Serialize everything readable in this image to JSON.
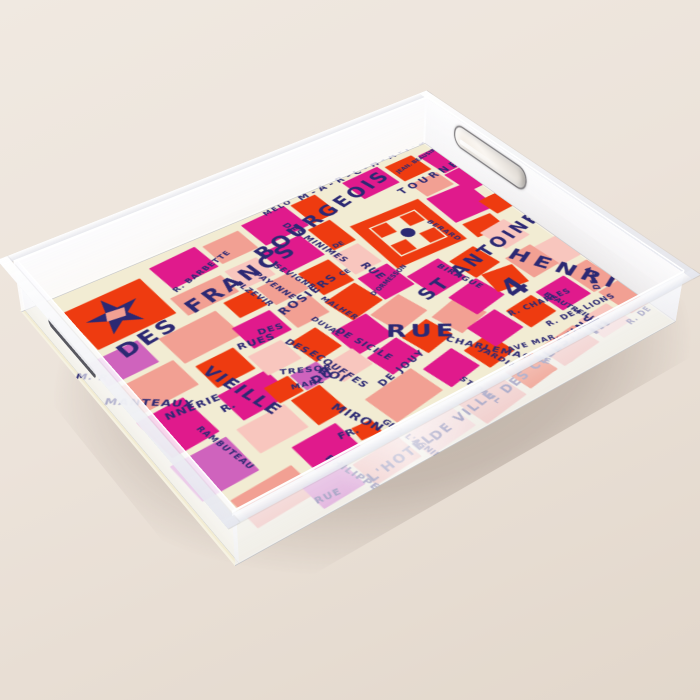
{
  "product": {
    "type": "acrylic serving tray product photo",
    "artwork": "Paris map print in pink, red and navy hand lettering",
    "setting": "beige studio surface"
  },
  "palette": {
    "background_top": "#f0e9e1",
    "background_bottom": "#e2d7cb",
    "cream": "#f2ecd3",
    "red": "#ee3b10",
    "magenta": "#e01a8c",
    "salmon": "#f2a093",
    "pink": "#f8c6be",
    "violet": "#cf63bd",
    "navy": "#2c2973"
  },
  "landmarks": {
    "star": "metro-star-marker",
    "place_square": "place-des-vosges-square",
    "place_dot": "place-des-vosges-dot"
  },
  "map": {
    "labels": [
      [
        "DES",
        48,
        104,
        27,
        3,
        -8
      ],
      [
        "FRANCS",
        136,
        86,
        27,
        4,
        -9
      ],
      [
        "BOURGEOIS",
        240,
        56,
        26,
        4,
        -12
      ],
      [
        "M-A-R-C-H-A-I-S",
        336,
        2,
        13,
        5,
        -3
      ],
      [
        "MELO",
        288,
        6,
        10,
        2,
        -6
      ],
      [
        "DES MINIMES",
        302,
        36,
        11,
        1,
        80
      ],
      [
        "JEAN. BEAUSIRE",
        456,
        28,
        8,
        0,
        -10
      ],
      [
        "TOURNELLES",
        434,
        58,
        14,
        5,
        -5
      ],
      [
        "R. BARBETTE",
        140,
        62,
        10,
        1,
        -16
      ],
      [
        "SEVIGNE",
        252,
        90,
        10,
        1,
        78
      ],
      [
        "PAYENNE",
        228,
        90,
        10,
        1,
        80
      ],
      [
        "ELZEVIR",
        204,
        90,
        10,
        1,
        80
      ],
      [
        "VIEILLE",
        114,
        182,
        19,
        2,
        75
      ],
      [
        "RUES",
        148,
        170,
        12,
        1,
        10
      ],
      [
        "DES",
        176,
        164,
        11,
        1,
        12
      ],
      [
        "ROSIERS",
        208,
        152,
        14,
        2,
        -12
      ],
      [
        "DES",
        196,
        194,
        11,
        1,
        72
      ],
      [
        "ECOUFFES",
        206,
        222,
        11,
        1,
        78
      ],
      [
        "TRESOR",
        162,
        226,
        10,
        1,
        28
      ],
      [
        "MARC",
        158,
        250,
        9,
        1,
        18
      ],
      [
        "DU",
        178,
        252,
        13,
        1,
        0
      ],
      [
        "ROI",
        198,
        246,
        13,
        1,
        65
      ],
      [
        "DE SICILE",
        246,
        210,
        11,
        1,
        75
      ],
      [
        "DUVAL",
        234,
        182,
        9,
        1,
        78
      ],
      [
        "MALHER",
        260,
        162,
        9,
        1,
        78
      ],
      [
        "MANTEAUX",
        10,
        162,
        12,
        1,
        38
      ],
      [
        "NNERIE",
        42,
        212,
        12,
        1,
        6
      ],
      [
        "RAMBUTEAU",
        62,
        246,
        9,
        1,
        80
      ],
      [
        "R.",
        88,
        234,
        12,
        0,
        0
      ],
      [
        "M. R.",
        4,
        116,
        11,
        1,
        40
      ],
      [
        "RUE",
        286,
        232,
        26,
        4,
        35
      ],
      [
        "ST ANTOINE",
        338,
        212,
        23,
        4,
        -11
      ],
      [
        "RUE",
        330,
        142,
        13,
        1,
        85
      ],
      [
        "D'ORMESSON",
        300,
        186,
        8,
        0,
        -18
      ],
      [
        "BIRAGUE",
        390,
        190,
        10,
        1,
        76
      ],
      [
        "BERARD",
        430,
        124,
        9,
        1,
        82
      ],
      [
        "CHARLEMAGNE",
        324,
        282,
        11,
        1,
        55
      ],
      [
        "DE JOUY",
        226,
        294,
        11,
        2,
        -12
      ],
      [
        "MIRON",
        180,
        294,
        13,
        1,
        70
      ],
      [
        "FR.",
        156,
        326,
        11,
        0,
        8
      ],
      [
        "PHILIPPE",
        136,
        344,
        10,
        1,
        76
      ],
      [
        "GEO. L'ASNIER",
        204,
        338,
        9,
        0,
        79
      ],
      [
        "ST PAUL",
        298,
        336,
        9,
        1,
        80
      ],
      [
        "RUE",
        94,
        378,
        10,
        1,
        6
      ],
      [
        "L'HOTEL",
        146,
        382,
        14,
        2,
        -6
      ],
      [
        "DE VILLE",
        222,
        376,
        14,
        2,
        -9
      ],
      [
        "DES CELESTINS",
        314,
        368,
        14,
        2,
        -11
      ],
      [
        "HENRI",
        472,
        214,
        26,
        6,
        62
      ],
      [
        "4",
        412,
        248,
        38,
        0,
        -8
      ],
      [
        "R. CHARLES",
        394,
        290,
        10,
        1,
        6
      ],
      [
        "BEAUTREILLIS",
        448,
        290,
        9,
        0,
        78
      ],
      [
        "R. DES LIONS",
        414,
        324,
        10,
        1,
        4
      ],
      [
        "AVE MAR.",
        358,
        330,
        9,
        1,
        14
      ],
      [
        "JARDINS",
        340,
        316,
        9,
        1,
        75
      ],
      [
        "DE LA",
        490,
        316,
        10,
        1,
        -62
      ],
      [
        "E",
        464,
        346,
        30,
        0,
        80
      ],
      [
        "R. DE",
        480,
        370,
        10,
        1,
        -8
      ],
      [
        "DE",
        316,
        98,
        9,
        0,
        0
      ],
      [
        "CE",
        294,
        140,
        9,
        0,
        0
      ]
    ],
    "blocks": [
      [
        140,
        16,
        58,
        44,
        -4,
        "magenta"
      ],
      [
        204,
        18,
        46,
        38,
        -2,
        "salmon"
      ],
      [
        258,
        10,
        58,
        46,
        -3,
        "magenta"
      ],
      [
        322,
        12,
        34,
        42,
        -2,
        "red"
      ],
      [
        394,
        10,
        52,
        40,
        -3,
        "magenta"
      ],
      [
        452,
        14,
        40,
        36,
        -2,
        "red"
      ],
      [
        498,
        18,
        30,
        46,
        -4,
        "magenta"
      ],
      [
        34,
        28,
        90,
        70,
        -2,
        "red"
      ],
      [
        132,
        72,
        62,
        34,
        -2,
        "salmon"
      ],
      [
        200,
        68,
        40,
        36,
        -1,
        "pink"
      ],
      [
        248,
        64,
        52,
        44,
        -3,
        "magenta"
      ],
      [
        312,
        60,
        30,
        46,
        -2,
        "red"
      ],
      [
        454,
        58,
        40,
        30,
        -2,
        "salmon"
      ],
      [
        498,
        66,
        28,
        42,
        -3,
        "magenta"
      ],
      [
        450,
        92,
        56,
        54,
        2,
        "magenta"
      ],
      [
        452,
        152,
        38,
        28,
        3,
        "red"
      ],
      [
        18,
        110,
        56,
        40,
        -2,
        "violet"
      ],
      [
        92,
        118,
        68,
        46,
        -3,
        "salmon"
      ],
      [
        172,
        110,
        34,
        30,
        -2,
        "red"
      ],
      [
        212,
        110,
        42,
        34,
        -3,
        "salmon"
      ],
      [
        260,
        116,
        40,
        44,
        -2,
        "red"
      ],
      [
        306,
        112,
        36,
        40,
        -3,
        "pink"
      ],
      [
        26,
        156,
        62,
        44,
        -3,
        "salmon"
      ],
      [
        158,
        148,
        46,
        38,
        -2,
        "magenta"
      ],
      [
        210,
        152,
        40,
        34,
        -2,
        "salmon"
      ],
      [
        258,
        166,
        44,
        40,
        -10,
        "red"
      ],
      [
        306,
        158,
        40,
        44,
        -3,
        "magenta"
      ],
      [
        460,
        172,
        38,
        38,
        -6,
        "pink"
      ],
      [
        496,
        128,
        30,
        30,
        -3,
        "red"
      ],
      [
        100,
        174,
        44,
        38,
        -2,
        "red"
      ],
      [
        18,
        206,
        52,
        58,
        -4,
        "magenta"
      ],
      [
        96,
        220,
        56,
        42,
        -3,
        "magenta"
      ],
      [
        148,
        192,
        40,
        34,
        -2,
        "pink"
      ],
      [
        194,
        198,
        34,
        38,
        -8,
        "red"
      ],
      [
        234,
        210,
        46,
        42,
        -4,
        "magenta"
      ],
      [
        284,
        208,
        44,
        38,
        -12,
        "salmon"
      ],
      [
        350,
        184,
        46,
        42,
        -6,
        "magenta"
      ],
      [
        402,
        190,
        38,
        38,
        -8,
        "red"
      ],
      [
        488,
        226,
        34,
        40,
        -2,
        "pink"
      ],
      [
        14,
        272,
        60,
        52,
        -2,
        "violet"
      ],
      [
        86,
        268,
        54,
        38,
        -2,
        "pink"
      ],
      [
        148,
        266,
        34,
        42,
        -3,
        "red"
      ],
      [
        136,
        238,
        28,
        26,
        -2,
        "red"
      ],
      [
        166,
        238,
        32,
        26,
        -3,
        "violet"
      ],
      [
        200,
        244,
        38,
        30,
        -6,
        "pink"
      ],
      [
        242,
        258,
        42,
        34,
        -10,
        "magenta"
      ],
      [
        288,
        254,
        38,
        34,
        -12,
        "red"
      ],
      [
        332,
        246,
        42,
        38,
        -14,
        "salmon"
      ],
      [
        364,
        234,
        44,
        38,
        -10,
        "magenta"
      ],
      [
        410,
        232,
        38,
        32,
        8,
        "red"
      ],
      [
        452,
        222,
        38,
        42,
        -4,
        "salmon"
      ],
      [
        114,
        316,
        50,
        38,
        -2,
        "magenta"
      ],
      [
        170,
        330,
        22,
        18,
        4,
        "red"
      ],
      [
        206,
        302,
        62,
        42,
        -8,
        "salmon"
      ],
      [
        276,
        302,
        42,
        36,
        -10,
        "magenta"
      ],
      [
        324,
        306,
        36,
        34,
        -8,
        "red"
      ],
      [
        348,
        282,
        42,
        38,
        -8,
        "magenta"
      ],
      [
        396,
        286,
        38,
        34,
        -6,
        "red"
      ],
      [
        440,
        282,
        42,
        38,
        -4,
        "magenta"
      ],
      [
        486,
        276,
        34,
        42,
        -3,
        "salmon"
      ],
      [
        36,
        336,
        66,
        40,
        -3,
        "salmon"
      ],
      [
        94,
        360,
        46,
        32,
        -3,
        "violet"
      ],
      [
        146,
        364,
        54,
        32,
        -4,
        "salmon"
      ],
      [
        206,
        362,
        58,
        34,
        -6,
        "pink"
      ],
      [
        272,
        358,
        56,
        36,
        -8,
        "salmon"
      ],
      [
        336,
        352,
        40,
        32,
        -8,
        "red"
      ],
      [
        384,
        346,
        52,
        34,
        -6,
        "salmon"
      ],
      [
        444,
        340,
        42,
        34,
        -4,
        "pink"
      ],
      [
        492,
        320,
        34,
        44,
        -4,
        "salmon"
      ]
    ]
  }
}
